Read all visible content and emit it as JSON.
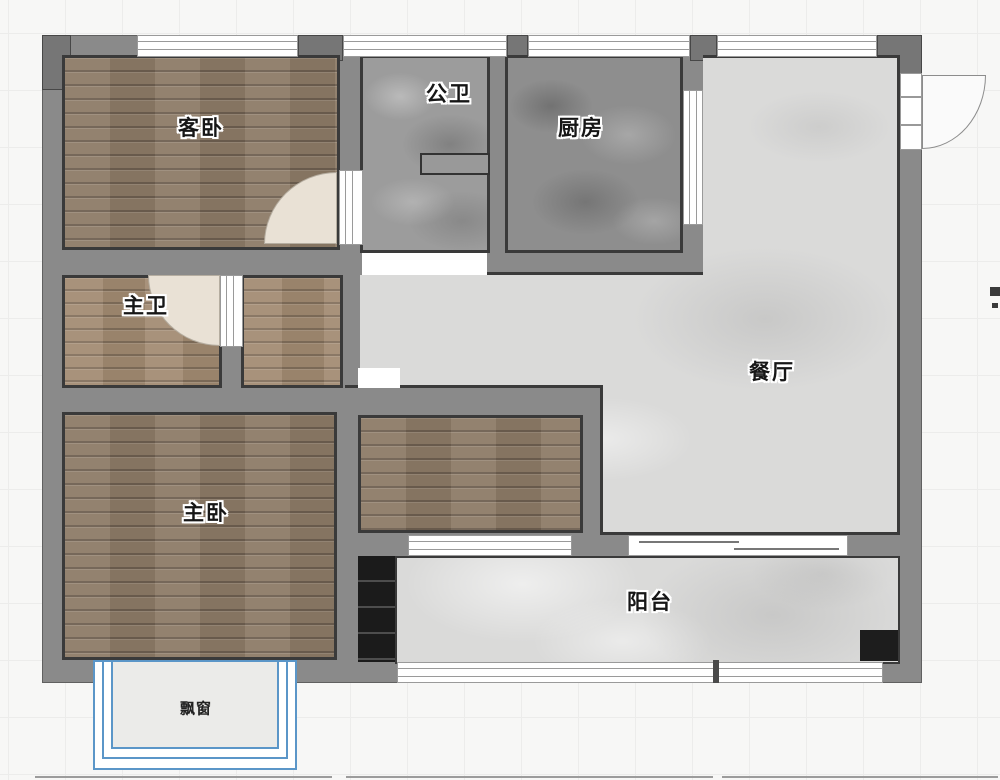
{
  "rooms": {
    "guest_bedroom": {
      "label": "客卧",
      "floor": "wood"
    },
    "guest_bathroom": {
      "label": "公卫",
      "floor": "gray-stone"
    },
    "kitchen": {
      "label": "厨房",
      "floor": "dark-stone"
    },
    "master_bathroom": {
      "label": "主卫",
      "floor": "wood"
    },
    "dining_room": {
      "label": "餐厅",
      "floor": "light-stone"
    },
    "master_bedroom": {
      "label": "主卧",
      "floor": "wood"
    },
    "balcony": {
      "label": "阳台",
      "floor": "light-stone"
    },
    "bay_window": {
      "label": "飘窗"
    }
  },
  "colors": {
    "wall": "#8a8a8a",
    "wall_outline": "#3a3a3a",
    "wood_floor": "#8c7a66",
    "wood_floor_light": "#a18a71",
    "stone_light": "#dadad9",
    "stone_medium": "#9c9c9c",
    "stone_dark": "#8e8e8e",
    "bay_window_accent": "#5b96c8",
    "cabinet_black": "#1b1b1b",
    "background": "#f7f7f6"
  }
}
